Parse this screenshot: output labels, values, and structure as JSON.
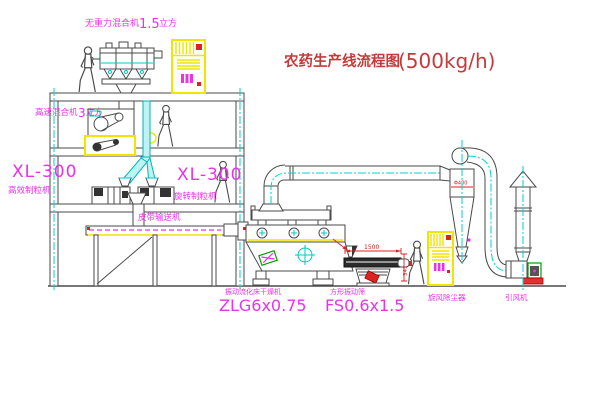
{
  "title": {
    "name_cn": "农药生产线流程图",
    "capacity": "(500kg/h)"
  },
  "labels": {
    "top_mixer": {
      "name": "无重力混合机",
      "size": "1.5",
      "unit": "立方"
    },
    "high_speed_mixer": {
      "name": "高速混合机",
      "size": "3",
      "unit": "立方"
    },
    "granulator_left": {
      "model": "XL-300",
      "name": "高效制粒机"
    },
    "granulator_right": {
      "model": "XL-300",
      "name": "旋转制粒机"
    },
    "belt_conveyor": {
      "name": "皮带输送机"
    },
    "fluid_bed_dryer": {
      "name": "振动流化床干燥机",
      "model": "ZLG6x0.75"
    },
    "vibrating_screen": {
      "name": "方形振动筛",
      "model": "FS0.6x1.5"
    },
    "cyclone_dust_collector": {
      "name": "旋风除尘器"
    },
    "induced_draft_fan": {
      "name": "引风机"
    }
  },
  "dimensions": {
    "screen_length": "1500",
    "screen_height": "341",
    "cyclone_diameter": "Φ400"
  },
  "colors": {
    "line": "#4a4a4a",
    "centerline_cyan": "#00d2d2",
    "label_magenta": "#e833e8",
    "cabinet_yellow": "#f0e400",
    "dimension_red": "#dd2222",
    "title_red": "#c43b3b",
    "background": "#ffffff"
  }
}
